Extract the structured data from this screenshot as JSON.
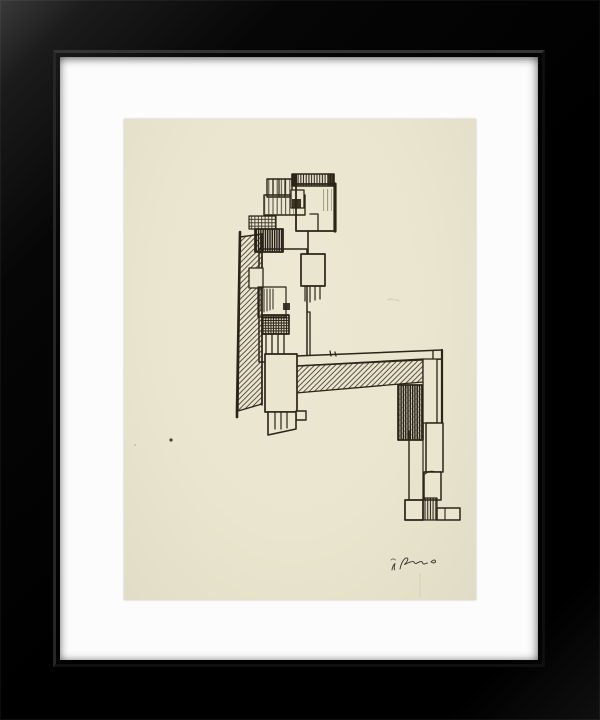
{
  "artwork": {
    "type": "framed ink drawing",
    "subject": "Abstract constructivist seated figure assembled from rectangles with vertical, diagonal and cross hatching, in black ink on cream paper",
    "frame": "black bevelled gallery frame with white mat board",
    "signature_text": "illegible artist monogram scribble, lower right",
    "colors": {
      "frame_black": "#050505",
      "frame_highlight": "#3a3a3a",
      "mat_white": "#fcfcfc",
      "paper_cream": "#e9e5ce",
      "ink": "#2b2418",
      "hatch": "#3e382b"
    }
  }
}
